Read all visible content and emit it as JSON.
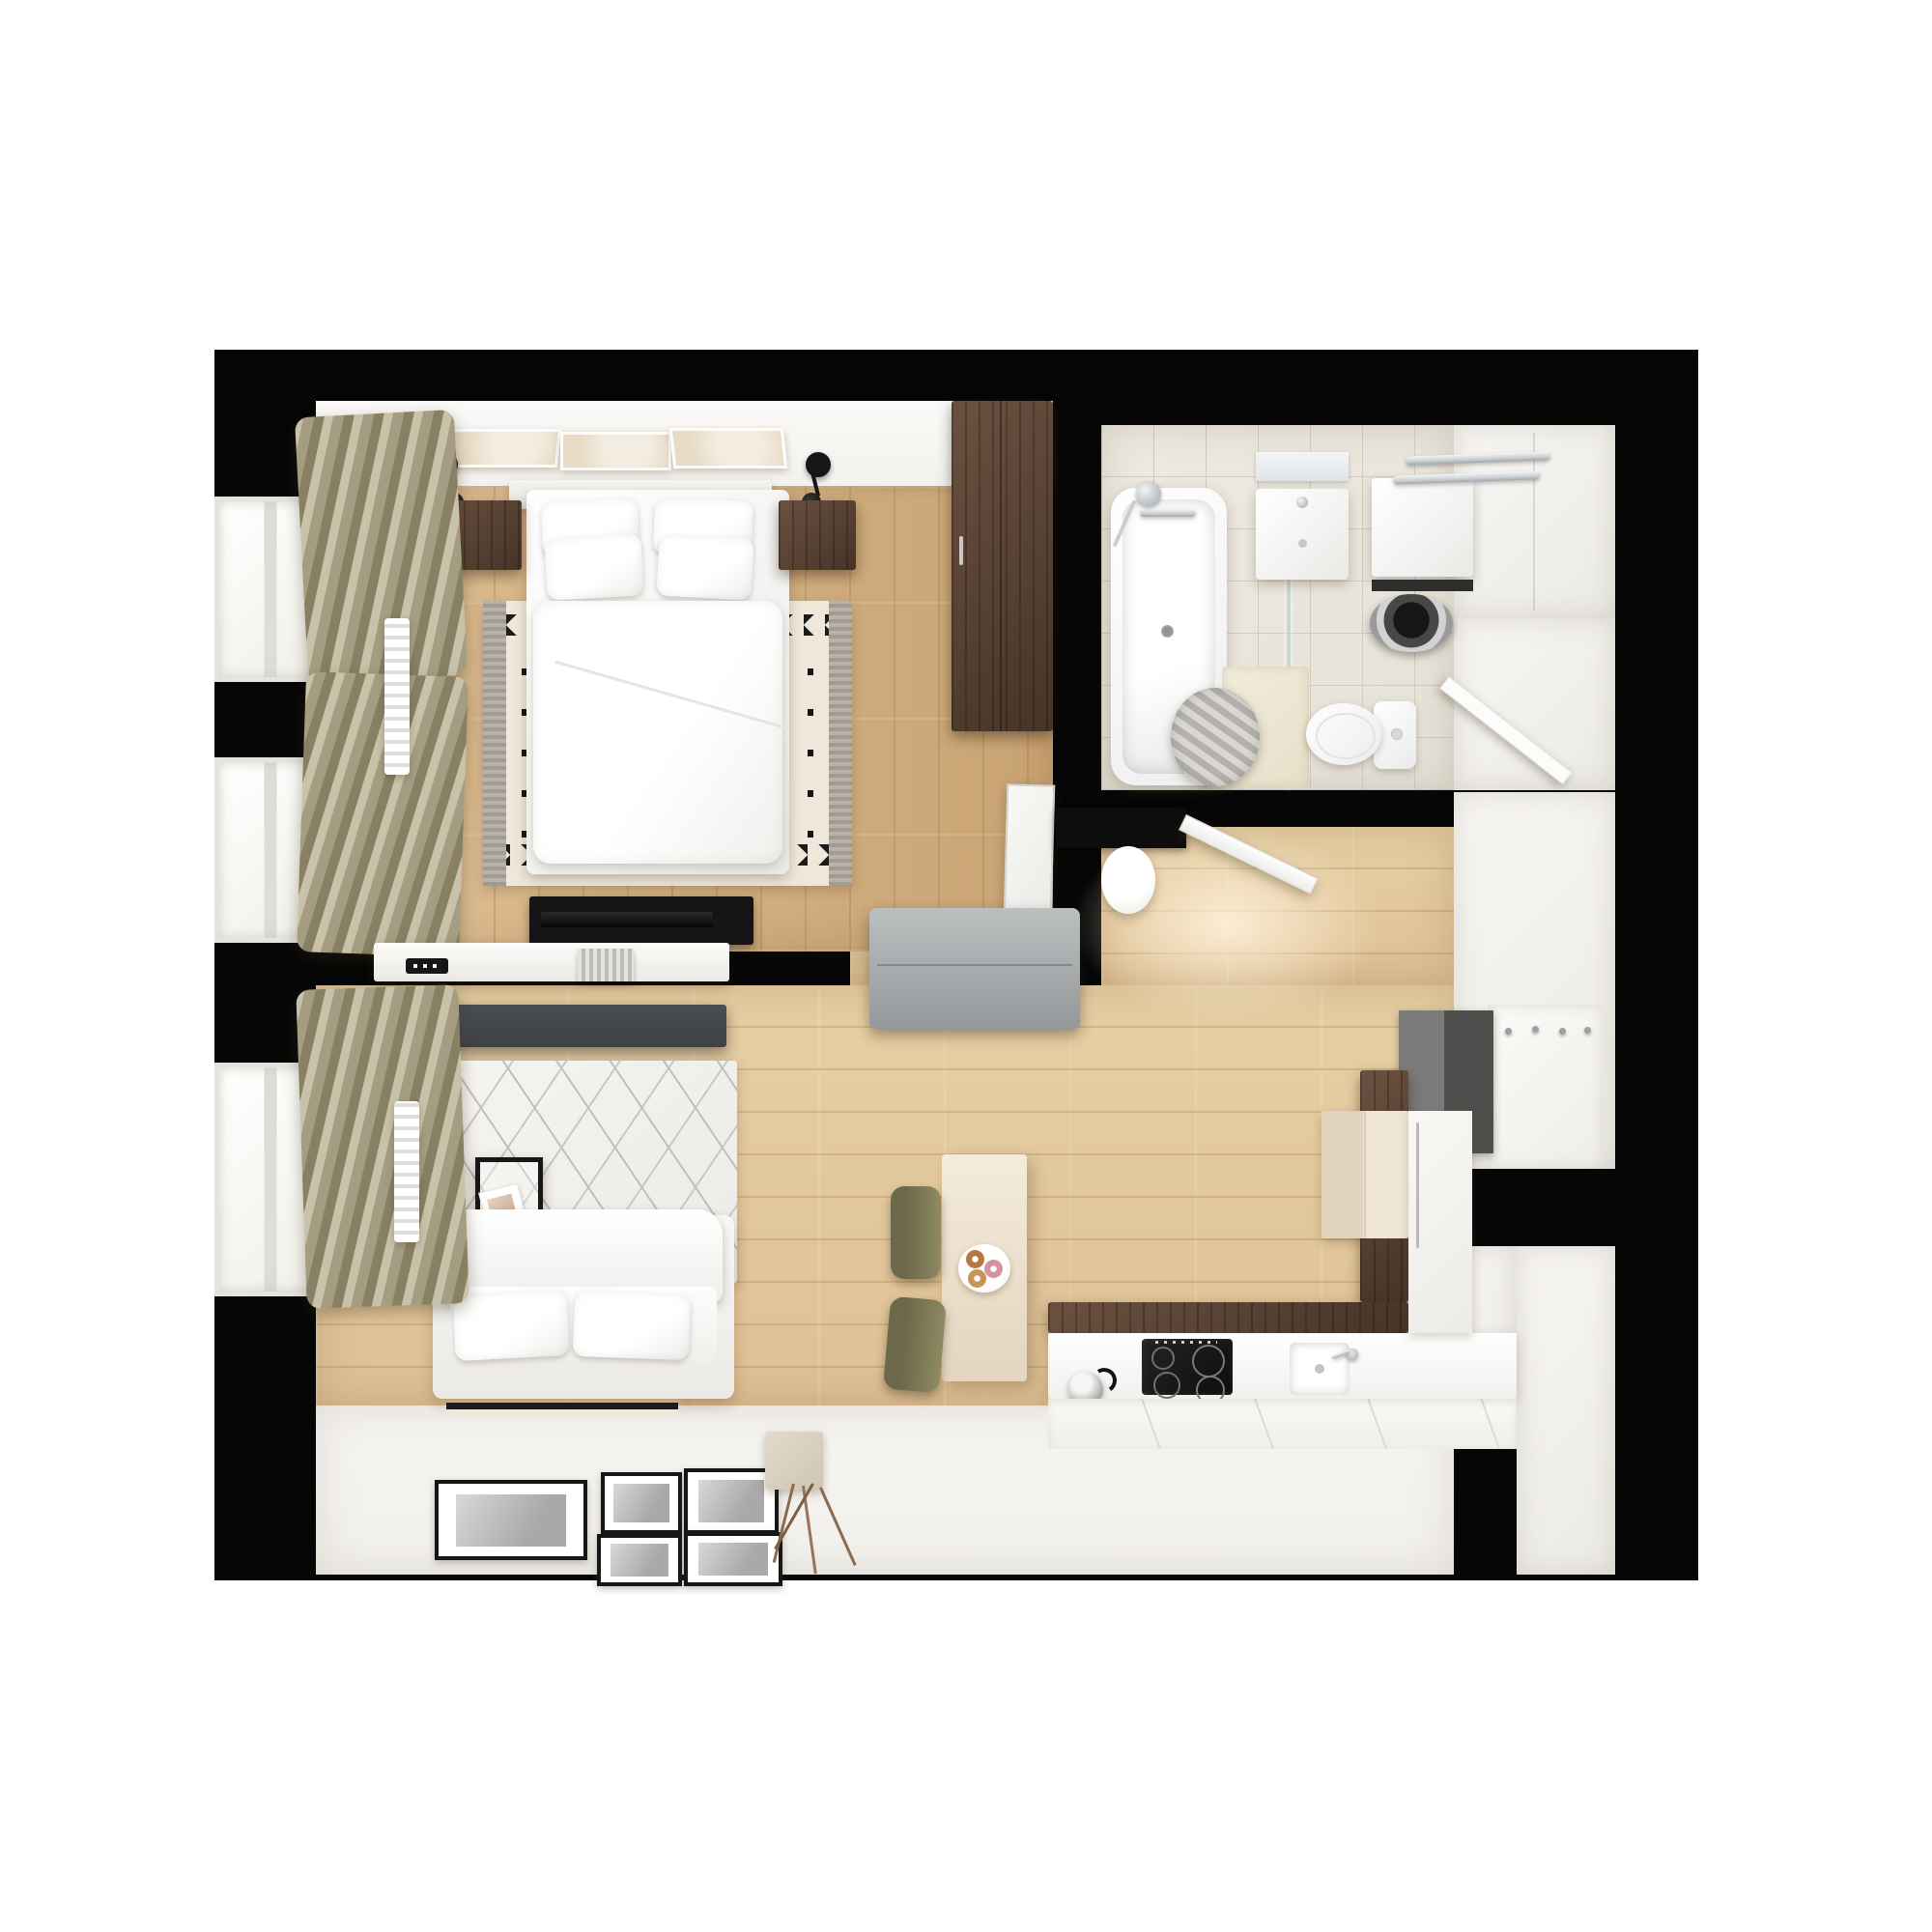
{
  "scene": {
    "kind": "photorealistic top-down 3D floor plan render",
    "background": "#ffffff",
    "apartment_type": "studio / one-bedroom apartment"
  },
  "palette": {
    "wall": "#060606",
    "wood": "#dfc095",
    "wood_deep": "#c9a372",
    "wood_kitchen": "#e7cfa4",
    "tile": "#e6e1d7",
    "tile_line": "#d2cbbf",
    "white_floor": "#f2f0ec",
    "furn_white": "#fbfbfa",
    "furn_white_dim": "#e9e9e6",
    "walnut": "#6b5140",
    "walnut_dark": "#463427",
    "khaki": "#a59d82",
    "khaki_light": "#c8c2aa",
    "khaki_dark": "#878063",
    "bench_gray": "#a9adae",
    "media_gray": "#3e4246",
    "olive": "#8e8a62",
    "olive_dark": "#6c684b",
    "cream_cab": "#efe6d4",
    "beige_cab": "#e2d4bc",
    "art_beige": "#e8dcc7",
    "rug_cream": "#efe8da",
    "rug_gray": "#a19b91",
    "rug_black": "#1c1c1c",
    "lattice_line": "#bfbfbd",
    "mat_dark": "#4f4f4d",
    "mat_mid": "#7b7b79",
    "chrome": "#c9ced1",
    "black": "#0d0d0d",
    "glow": "#fff3dd"
  },
  "rooms": [
    {
      "name": "bedroom",
      "furniture": [
        "double-bed",
        "headboard",
        "pillow x4",
        "duvet",
        "zigzag-rug",
        "nightstand x2",
        "wall-sconce x2",
        "triptych-artwork",
        "walnut-wardrobe",
        "leaning-mirror",
        "tv-bench",
        "tv",
        "window x2",
        "roman-curtains x2",
        "radiator"
      ]
    },
    {
      "name": "bathroom",
      "furniture": [
        "bathtub",
        "hand-shower",
        "glass-partition",
        "vanity-sink",
        "vanity-mirror",
        "washing-machine",
        "toilet",
        "towel-rail x2",
        "towel-basket",
        "bath-mat",
        "storage-closet",
        "bathroom-door"
      ]
    },
    {
      "name": "hallway",
      "furniture": [
        "entry-door-frame",
        "entry-door-leaf",
        "round-pouf",
        "gray-bench",
        "doormat",
        "coat-hook-panel",
        "hall-closet"
      ]
    },
    {
      "name": "living-room",
      "furniture": [
        "floor-sofa",
        "seat-cushion x2",
        "lattice-rug",
        "metal-glass-side-table",
        "magazines",
        "cup",
        "floating-console-shelf",
        "ribbed-decor",
        "soundbar",
        "media-cabinet",
        "picture-frame x5",
        "driftwood-decor",
        "storage-box",
        "window",
        "roman-curtain",
        "radiator",
        "led-floor-strip"
      ]
    },
    {
      "name": "kitchen",
      "furniture": [
        "walnut-counter-L",
        "white-countertop",
        "induction-hob",
        "burner x4",
        "kitchen-sink",
        "faucet",
        "kettle",
        "base-cabinet-fronts",
        "beige-cabinet-block",
        "tall-cabinet",
        "counter-return",
        "upper-cabinet-column",
        "bar-island",
        "bar-chair x2",
        "donut-plate",
        "donut x3"
      ]
    }
  ],
  "counts": {
    "windows": 3,
    "pillows_bed": 4,
    "picture_frames": 5,
    "donuts": 3,
    "bar_chairs": 2,
    "coat_hooks": 4
  }
}
